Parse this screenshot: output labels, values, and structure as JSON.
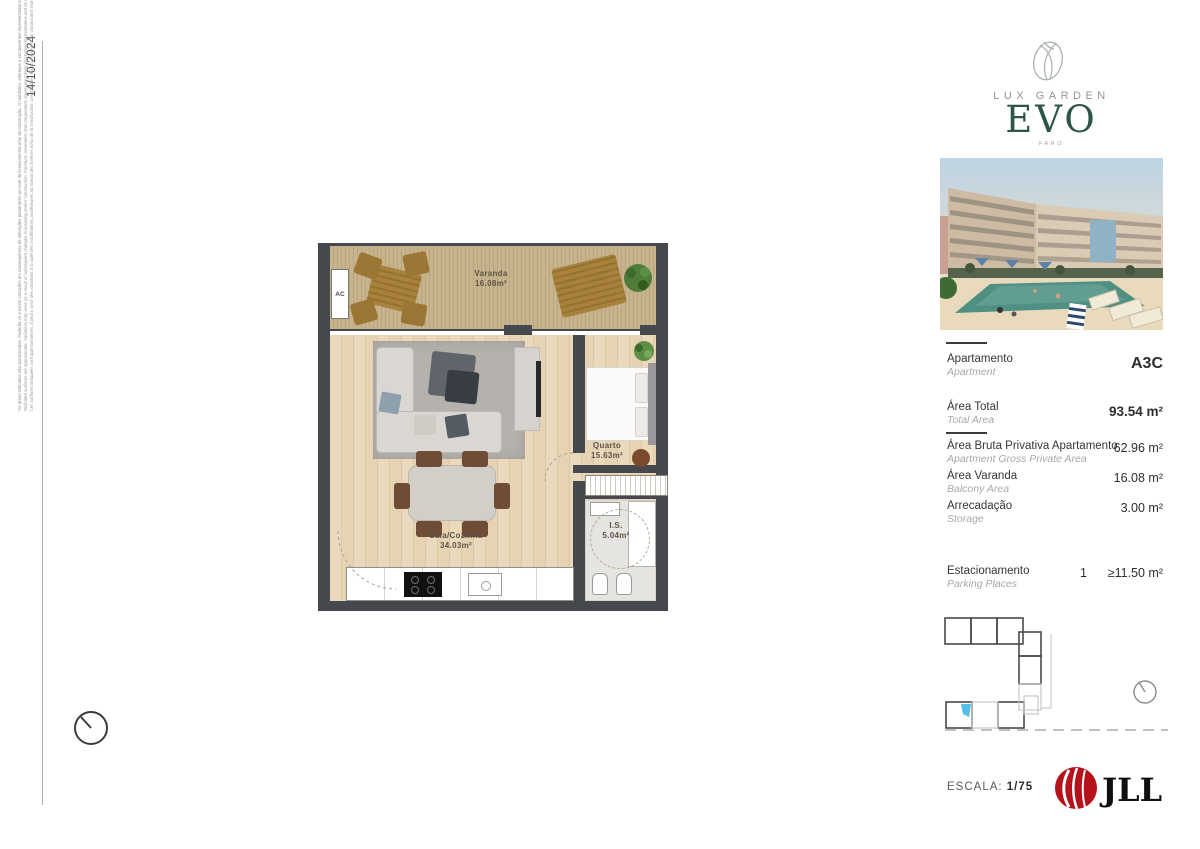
{
  "meta": {
    "date": "14/10/2024"
  },
  "disclaimer": {
    "pt": "\"As áreas indicadas são aproximadas. Poderão vir a existir variações em consequência de alterações posteriores ao nível do licenciamento e/ou da construção. O mobiliário, adereços e componentes representados são meramente ilustrativos/representativos e não retratam a realidade.\"",
    "en": "\"Indicated surfaces are approximate. Variations may arise as a result of subsequent changes in licensing and/or construction. Furniture, ornaments and components shown are merely illustrative/representative and do not reflect reality.\"",
    "fr": "\"Les surfaces indiquées sont approximatives. Il peut y avoir des variations à la suite des modifications postérieures au niveau des licences et/ou de la construction. Les meubles, les accessoires et les composants représentés sont simplement illustratifs / représentatifs et ne représentent pas la réalité.\""
  },
  "brand": {
    "top": "LUX GARDEN",
    "main": "EVO",
    "sub": "FARO"
  },
  "floorplan": {
    "ac_label": "AC",
    "rooms": [
      {
        "name": "Varanda",
        "area": "16.08m²"
      },
      {
        "name": "Sala/Cozinha",
        "area": "34.03m²"
      },
      {
        "name": "Quarto",
        "area": "15.63m²"
      },
      {
        "name": "I.S.",
        "area": "5.04m²"
      }
    ]
  },
  "details": {
    "apartment": {
      "label_pt": "Apartamento",
      "label_en": "Apartment",
      "value": "A3C"
    },
    "total": {
      "label_pt": "Área Total",
      "label_en": "Total Area",
      "value": "93.54 m²"
    },
    "gross": {
      "label_pt": "Área Bruta Privativa Apartamento",
      "label_en": "Apartment Gross Private Area",
      "value": "62.96 m²"
    },
    "balcony": {
      "label_pt": "Área Varanda",
      "label_en": "Balcony Area",
      "value": "16.08 m²"
    },
    "storage": {
      "label_pt": "Arrecadação",
      "label_en": "Storage",
      "value": "3.00 m²"
    },
    "parking": {
      "label_pt": "Estacionamento",
      "label_en": "Parking Places",
      "count": "1",
      "value": "≥11.50 m²"
    }
  },
  "footer": {
    "scale_label": "ESCALA:",
    "scale_value": "1/75",
    "agency": "JLL"
  },
  "colors": {
    "brand_green": "#2c5546",
    "jll_red": "#b5121b",
    "unit_highlight": "#52c0e8",
    "wall": "#45484c"
  }
}
